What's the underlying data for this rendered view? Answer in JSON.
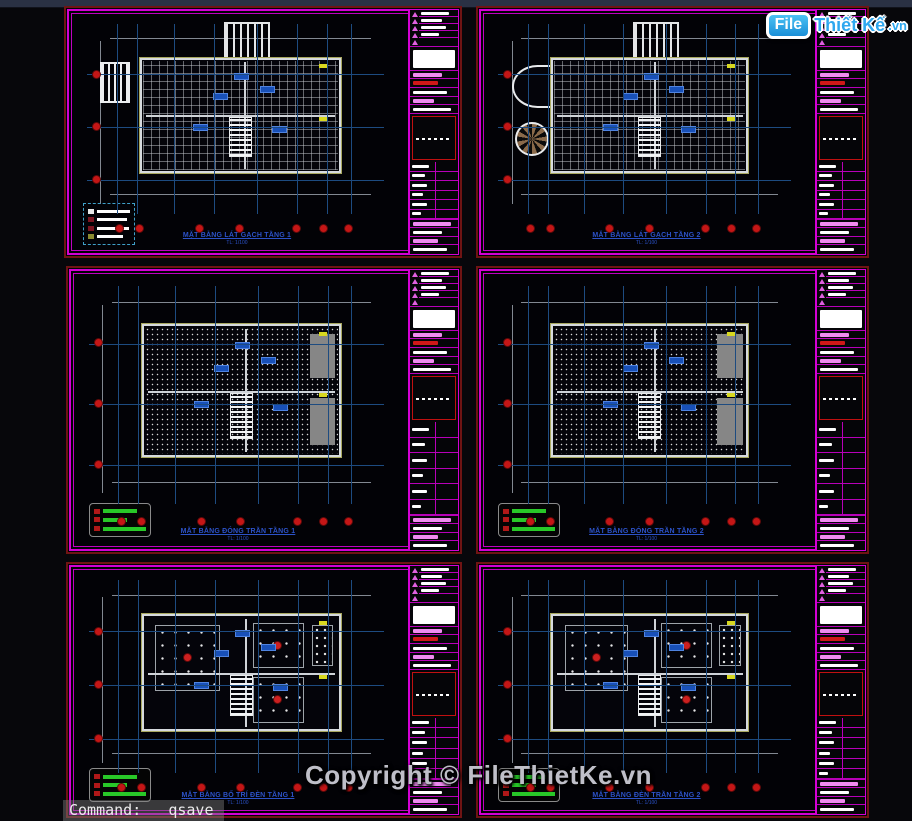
{
  "app": {
    "command_line": "Command:   qsave"
  },
  "watermark": {
    "copyright": "Copyright © FileThietKe.vn",
    "logo_file": "File",
    "logo_rest": "Thiết Kế",
    "logo_tld": ".vn"
  },
  "sheets": [
    {
      "id": "tile-plan-floor-1",
      "title": "MẶT BẰNG LÁT GẠCH TẦNG 1",
      "scale": "TL: 1/100",
      "type": "tile"
    },
    {
      "id": "tile-plan-floor-2",
      "title": "MẶT BẰNG LÁT GẠCH TẦNG 2",
      "scale": "TL: 1/100",
      "type": "tile"
    },
    {
      "id": "ceiling-plan-floor-1",
      "title": "MẶT BẰNG ĐÓNG TRẦN TẦNG 1",
      "scale": "TL: 1/100",
      "type": "ceiling"
    },
    {
      "id": "ceiling-plan-floor-2",
      "title": "MẶT BẰNG ĐÓNG TRẦN TẦNG 2",
      "scale": "TL: 1/100",
      "type": "ceiling"
    },
    {
      "id": "lighting-plan-floor-1",
      "title": "MẶT BẰNG BỐ TRÍ ĐÈN TẦNG 1",
      "scale": "TL: 1/100",
      "type": "light"
    },
    {
      "id": "lighting-plan-floor-2",
      "title": "MẶT BẰNG ĐÈN TRẦN TẦNG 2",
      "scale": "TL: 1/100",
      "type": "light"
    }
  ],
  "colors": {
    "frame_magenta": "#d400d4",
    "frame_dark_red": "#6f1414",
    "axis_blue": "#1d4b80",
    "grid_bubble_red": "#c41616",
    "title_blue": "#2c52c8",
    "legend_green": "#28c828",
    "logo_blue": "#2fa8ef"
  }
}
